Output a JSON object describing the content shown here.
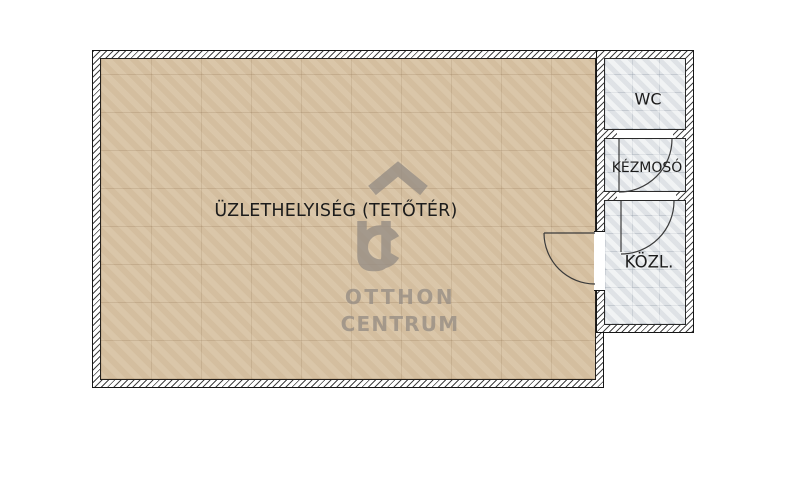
{
  "floorplan": {
    "main_room": {
      "label": "ÜZLETHELYISÉG (TETŐTÉR)"
    },
    "rooms": [
      {
        "id": "wc",
        "label": "WC"
      },
      {
        "id": "kezmoso",
        "label": "KÉZMOSÓ"
      },
      {
        "id": "kozl",
        "label": "KÖZL."
      }
    ],
    "doors": [
      {
        "between": "kozl-and-main-room",
        "swings_into": "main_room"
      },
      {
        "between": "wc-and-kezmoso",
        "swings_into": "kezmoso"
      },
      {
        "between": "kezmoso-and-kozl",
        "swings_into": "kozl"
      }
    ],
    "watermark": {
      "monogram": "OC",
      "line1": "OTTHON",
      "line2": "CENTRUM"
    },
    "colors": {
      "background": "#ffffff",
      "main_floor": "#d8c3a4",
      "tile_floor": "#e6e9eb",
      "wall_fill": "#ffffff",
      "wall_hatch": "#444444",
      "wall_outline": "#161616",
      "door_line": "#3a3a3a",
      "watermark": "#968d84",
      "label_text": "#1c1c1c"
    }
  }
}
